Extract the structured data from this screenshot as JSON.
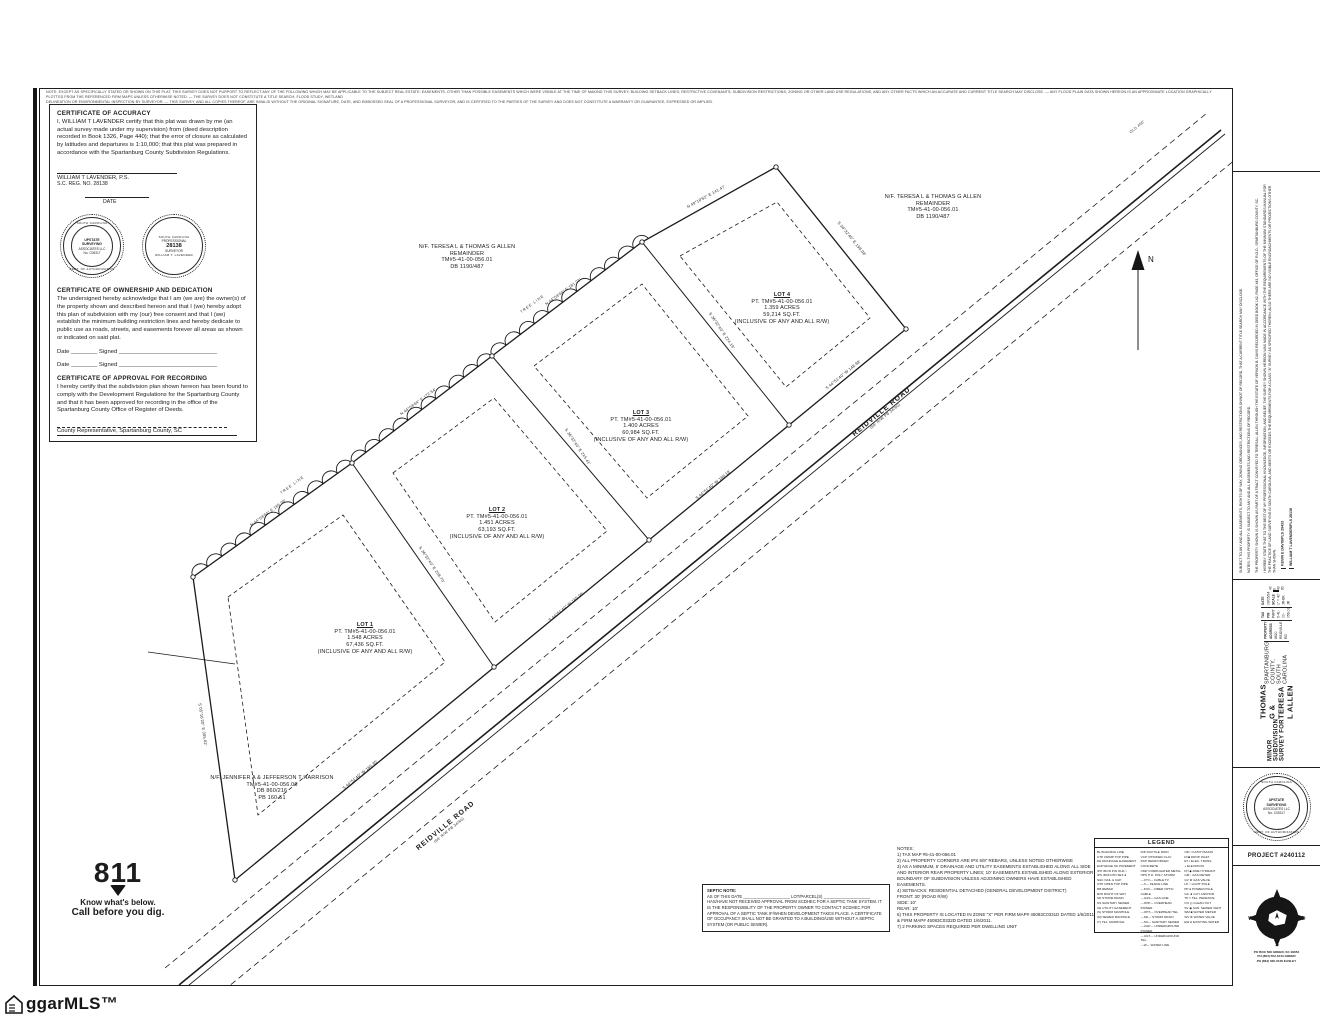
{
  "disclaimer": {
    "line1": "NOTE: EXCEPT AS SPECIFICALLY STATED OR SHOWN ON THIS PLAT, THIS SURVEY DOES NOT PURPORT TO REFLECT ANY OF THE FOLLOWING WHICH MAY BE APPLICABLE TO THE SUBJECT REAL ESTATE: EASEMENTS, OTHER THAN POSSIBLE EASEMENTS WHICH WERE VISIBLE AT THE TIME OF MAKING THIS SURVEY; BUILDING SETBACK LINES; RESTRICTIVE COVENANTS; SUBDIVISION RESTRICTIONS; ZONING OR OTHER LAND USE REGULATIONS, AND ANY OTHER FACTS WHICH AN ACCURATE AND CURRENT TITLE SEARCH MAY DISCLOSE. — ANY FLOOD PLAIN DATA SHOWN HEREON IS AN APPROXIMATE LOCATION GRAPHICALLY PLOTTED FROM THE REFERENCED FIRM MAPS UNLESS OTHERWISE NOTED. — THE SURVEY DOES NOT CONSTITUTE A TITLE SEARCH, FLOOD STUDY, WETLAND",
    "line2": "DELINEATION OR ENVIRONMENTAL INSPECTION BY SURVEYOR. — THIS SURVEY, AND ALL COPIES THEREOF, ARE INVALID WITHOUT THE ORIGINAL SIGNATURE, DATE, AND EMBOSSED SEAL OF A PROFESSIONAL SURVEYOR, AND IS CERTIFIED TO THE PARTIES OF THE SURVEY AND DOES NOT CONSTITUTE A WARRANTY OR GUARANTEE, EXPRESSED OR IMPLIED."
  },
  "certificates": {
    "accuracy_title": "CERTIFICATE OF ACCURACY",
    "accuracy_body": "I, WILLIAM T LAVENDER certify that this plat was drawn by me (an actual survey made under my supervision) from (deed description recorded in Book 1326, Page 440); that the error of closure as calculated by latitudes and departures is 1:10,000; that this plat was prepared in accordance with the Spartanburg County Subdivision Regulations.",
    "signer_name": "WILLIAM T LAVENDER,   P.S.",
    "signer_reg": "S.C. REG. NO. 28138",
    "date_label": "DATE",
    "ownership_title": "CERTIFICATE OF OWNERSHIP AND DEDICATION",
    "ownership_body": "The undersigned hereby acknowledge that I am (we are) the owner(s) of the property shown and described hereon and that I (we) hereby adopt this plan of subdivision with my (our) free consent and that I (we) establish the minimum building restriction lines and hereby dedicate to public use as roads, streets, and easements forever all areas as shown or indicated on said plat.",
    "date_signed_1": "Date ________  Signed ______________________________",
    "date_signed_2": "Date ________  Signed ______________________________",
    "approval_title": "CERTIFICATE OF APPROVAL FOR RECORDING",
    "approval_body": "I hereby certify that the subdivision plan shown hereon has been found to comply with the Development Regulations for the Spartanburg County and that it has been approved for recording in the office of the Spartanburg County Office of Register of Deeds.",
    "county_rep": "County Representative, Spartanburg County, SC"
  },
  "seals": {
    "firm": {
      "ring_top": "SOUTH CAROLINA",
      "l1": "UPSTATE",
      "l2": "SURVEYING",
      "l3": "ASSOCIATES LLC",
      "l4": "No. C05317",
      "ring_bottom": "CERT. OF AUTHORIZATION"
    },
    "surveyor": {
      "ring_top": "SOUTH CAROLINA",
      "l1": "PROFESSIONAL",
      "num": "28138",
      "l2": "SURVEYOR",
      "name": "WILLIAM T. LAVENDER"
    }
  },
  "plat": {
    "lots": [
      {
        "name": "LOT 1",
        "tm": "PT. TM#5-41-00-056.01",
        "acres": "1.548 ACRES",
        "sqft": "67,436 SQ.FT.",
        "rw": "(INCLUSIVE OF ANY AND ALL R/W)"
      },
      {
        "name": "LOT 2",
        "tm": "PT. TM#5-41-00-056.01",
        "acres": "1.451 ACRES",
        "sqft": "63,193 SQ.FT.",
        "rw": "(INCLUSIVE OF ANY AND ALL R/W)"
      },
      {
        "name": "LOT 3",
        "tm": "PT. TM#5-41-00-056.01",
        "acres": "1.400 ACRES",
        "sqft": "60,984 SQ.FT.",
        "rw": "(INCLUSIVE OF ANY AND ALL R/W)"
      },
      {
        "name": "LOT 4",
        "tm": "PT. TM#5-41-00-056.01",
        "acres": "1.359 ACRES",
        "sqft": "59,214 SQ.FT.",
        "rw": "(INCLUSIVE OF ANY AND ALL R/W)"
      }
    ],
    "adjoiner_allen": [
      "N/F. TERESA L & THOMAS G ALLEN",
      "REMAINDER",
      "TM#5-41-00-056.01",
      "DB 1190/487"
    ],
    "adjoiner_harrison": [
      "N/F. JENNIFER A & JEFFERSON T HARRISON",
      "TM#5-41-00-056.06",
      "DB 860/216",
      "PB 160-51"
    ],
    "road_name": "REIDVILLE ROAD",
    "road_rw": "(66' R/W  PB 34/60)",
    "tree_label": "TREE LINE",
    "tie_label": "OLD 460'",
    "north_label": "N",
    "bearings": [
      "N 44°03'04\" E  165.06'",
      "N 44°03'04\" E  172.54'",
      "N 44°03'04\" E  181.01'",
      "N 49°10'52\" E  141.47'",
      "S 44°51'40\" W  160.35'",
      "S 44°51'40\" W  165.06'",
      "S 44°51'40\" W  169.18'",
      "S 44°51'40\" W  148.98'",
      "S 36°32'40\" E  208.70'",
      "S 36°32'40\" E  215.41'",
      "S 36°32'40\" E  224.19'",
      "S 36°32'40\" E  198.08'",
      "S 05°16'20\" E  305.62'"
    ]
  },
  "notes": [
    "NOTES:",
    "1) TAX MAP #5-41-00-056.01",
    "2) ALL PROPERTY CORNERS ARE IPS 5/8\" REBARS, UNLESS NOTED OTHERWISE",
    "3) AS A MINIMUM, 5' DRAINAGE AND UTILITY EASEMENTS ESTABLISHED ALONG ALL SIDE AND INTERIOR REAR PROPERTY LINES; 10' EASEMENTS ESTABLISHED ALONG EXTERIOR BOUNDARY OF SUBDIVISION UNLESS ADJOINING OWNERS HAVE ESTABLISHED EASEMENTS.",
    "4) SETBACKS: RESIDENTIAL DETACHED (GENERAL DEVELOPMENT DISTRICT)",
    "      FRONT: 30' (ROAD R/W)",
    "      SIDE: 10'",
    "      REAR: 10'",
    "6) THIS PROPERTY IS LOCATED IN ZONE \"X\" PER FIRM MAP# 45083C0331D DATED 1/6/2011 & FIRM MAP# 45083C0332D DATED 1/6/2011.",
    "7) 2 PARKING SPACES REQUIRED PER DWELLING UNIT"
  ],
  "septic": {
    "title": "SEPTIC NOTE:",
    "blanks": "AS OF THIS DATE ____________________ LOT/PARCEL(S) ____________________",
    "body": "HAS/HAVE NOT RECEIVED APPROVAL FROM SCDHEC FOR A SEPTIC TANK SYSTEM.  IT IS THE RESPONSIBILITY OF THE PROPERTY OWNER TO CONTACT SCDHEC FOR APPROVAL OF A SEPTIC TANK IF/WHEN DEVELOPMENT TAKES PLACE. A CERTIFICATE OF OCCUPANCY SHALL NOT BE GRANTED TO A BUILDING/USE WITHOUT A SEPTIC SYSTEM (OR PUBLIC SEWER)."
  },
  "legend": {
    "title": "LEGEND",
    "col1": [
      "BL  BUILDING LINE",
      "CTP CRIMP TOP PIPE",
      "DE  DRAINAGE EASEMENT",
      "EOP EDGE OF PAVEMENT",
      "IPO IRON PIN OLD-○",
      "IPS IRON PIN SET-●",
      "N&C NAIL & CAP",
      "OTP OPEN TOP PIPE",
      "RB  REBAR",
      "R/W RIGHT OF WAY",
      "SD  STORM DRAIN",
      "SS  SANITARY SEWER",
      "UE  UTILITY EASEMENT",
      "(S) STORM MANHOLE",
      "(M) SEWER MANHOLE",
      "(T) TEL. MANHOLE"
    ],
    "col2": [
      "DIP DUCTILE IRON",
      "VCP VITRIFIED CLAY",
      "RCP REINFORCED CONCRETE",
      "CMP CORRUGATED METAL",
      "HPS H.D. POLY STORM",
      "—CTV— CABLE TV",
      "—X— FENCE LINE",
      "—FOC— FIBER OPTIC CABLE",
      "—GAS— GAS LINE",
      "—OHP— OVERHEAD POWER",
      "—OHT— OVERHEAD TEL.",
      "—SD— STORM DRAIN",
      "—SS— SANITARY SEWER",
      "—UGP— UNDERGROUND POWER",
      "—UGT— UNDERGROUND TEL.",
      "—W— WATER LINE"
    ],
    "col3": [
      "CB □ CATCH BASIN",
      "DI ■ DROP INLET",
      "ET ▪ ELEC. TRANS.",
      "+  ELEVATION",
      "FH ◆ FIRE HYDRANT",
      "GM ▫ GAS METER",
      "GV ⊗ GAS VALVE",
      "LP ○ LIGHT POLE",
      "PP ● POWER POLE",
      "GA ◄ GUY ANCHOR",
      "TP □ TEL. PEDESTAL",
      "CO ◎ CLEAN OUT",
      "SV ◉ SAN. SEWER VENT",
      "WM ■ WATER METER",
      "WV ⊗ WATER VALVE",
      "EW ● EXISTING WATER"
    ]
  },
  "title_block": {
    "legal_p0": "SUBJECT TO ANY AND ALL EASEMENTS, RIGHTS OF WAY, ZONING ORDINANCES, AND RESTRICTIONS ON/NOT OF RECORD, THAT A CURRENT TITLE SEARCH MAY DISCLOSE.",
    "legal_p1": "NOTES: THIS PROPERTY IS SUBJECT TO ANY AND ALL EASEMENTS AND RESTRICTIONS OF RECORD.",
    "legal_p2": "THE PROPERTY SHOWN IS SHOWN AS PART OF A TRACT CONVEYED TO TERESA L. ALLEN THROUGH THE ESTATE OF VERNON B. DAVIS RECORDED IN DEED BOOK 142, PAGE 443, OFFICE OF R.O.D., SPARTANBURG COUNTY, SC.",
    "legal_p3": "I HEREBY STATE THAT TO THE BEST OF MY PROFESSIONAL KNOWLEDGE, INFORMATION, AND BELIEF, THE SURVEY SHOWN HEREON WAS MADE IN ACCORDANCE WITH THE REQUIREMENTS OF THE MINIMUM STANDARDS MANUAL FOR THE PRACTICE OF LAND SURVEYING IN SOUTH CAROLINA, AND MEETS OR EXCEEDS THE REQUIREMENTS FOR A CLASS \"A\" SURVEY AS SPECIFIED THEREIN; ALSO THERE ARE NO VISIBLE ENCROACHMENTS OR PROJECTIONS OTHER THAN SHOWN.",
    "signer1": "KEVIN E DAVIS/PLS 29433",
    "signer2": "WILLIAM T LAVENDER/PLS 28138",
    "title1": "MINOR SUBDIVISION SURVEY FOR",
    "title2": "THOMAS G & TERESA L ALLEN",
    "title3": "SPARTANBURG COUNTY, SOUTH CAROLINA",
    "addr_label": "PROPERTY ADDRESS",
    "addr_value": "8620 REIDVILLE RD",
    "pin_label": "TAX PIN",
    "pin_value": "PART 5-41-00-056.01",
    "date_label": "DATE",
    "date_value": "09/05/24",
    "scale_label": "SCALE",
    "scale_value": "1\" = 40'",
    "crew_value": "JR-BK",
    "drawn_value": "JR",
    "scale_ticks": "40   0   40   80",
    "project": "PROJECT #240112",
    "logo_name": "UPSTATE SURVEYING ASSOCIATES",
    "logo_addr1": "PO BOX 568 GREER, SC 29652",
    "logo_addr2": "PH (864) 552-1043 GREER",
    "logo_addr3": "PH (864) 630-0106 EASLEY",
    "compass_n": "N",
    "compass_e": "E",
    "compass_s": "S",
    "compass_w": "W"
  },
  "call811": {
    "number": "811",
    "line1": "Know what's below.",
    "line2": "Call before you dig."
  },
  "watermark": "ggarMLS™"
}
